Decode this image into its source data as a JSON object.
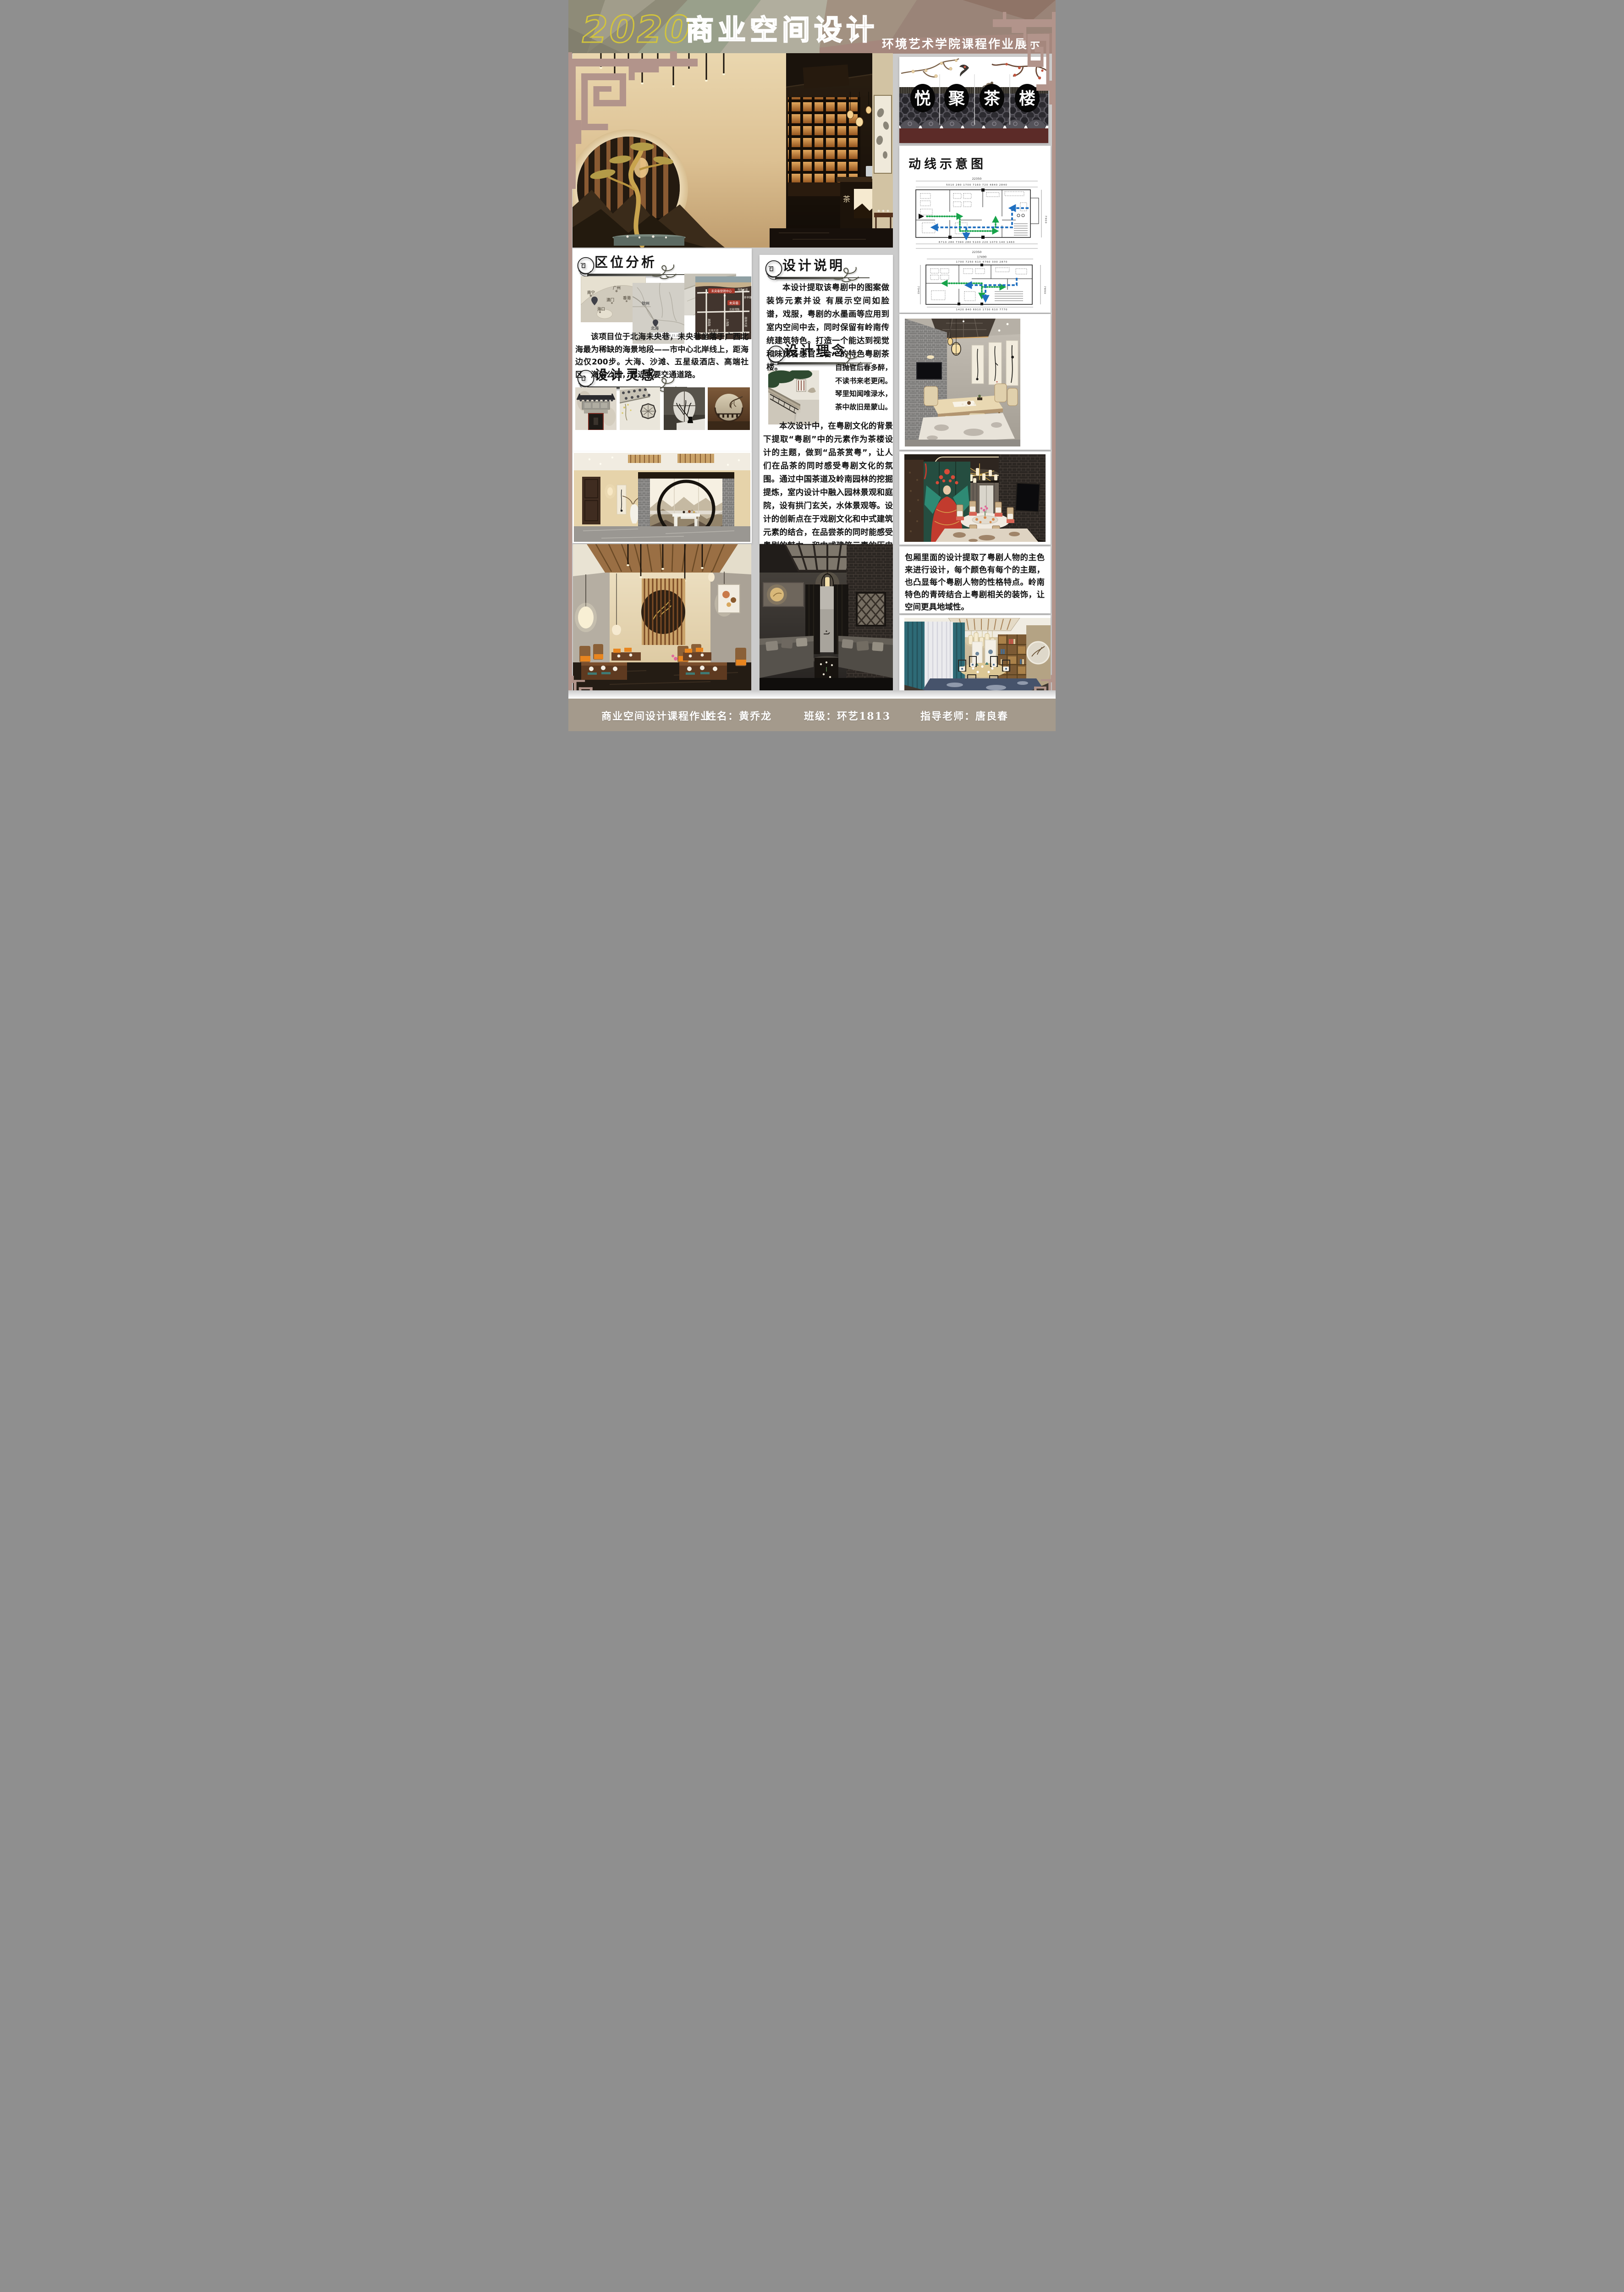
{
  "header": {
    "year": "2020",
    "title": "商业空间设计",
    "subtitle": "环境艺术学院课程作业展示"
  },
  "logo": {
    "char1": "悦",
    "char2": "聚",
    "char3": "茶",
    "char4": "楼"
  },
  "hero": {
    "desk_char": "茶"
  },
  "circulation": {
    "title": "动线示意图",
    "plan1_total_top": "22350",
    "plan1_dims_top": "5010   280  1700     7160      720    4840     2840",
    "plan1_dims_bottom": "6710    280     7390     280    5100   220 1070 140 1460",
    "plan1_total_bottom": "22350",
    "plan1_total_right": "7900",
    "plan2_total_top": "17490",
    "plan2_dims_top": "1700     7250     610    4760    300   2870",
    "plan2_dims_bottom": "1420 840   6910    1730 610    7770",
    "plan2_total_left": "7940",
    "plan2_total_right": "7890"
  },
  "location": {
    "title": "区位分析",
    "body": "该项目位于北海未央巷，未央巷坐落于广西北海最为稀缺的海景地段——市中心北岸线上，距海边仅200步。大海、沙滩、五星级酒店、高端社区、海滨公园，靠近主要交通道路。",
    "map1_label1": "南宁",
    "map1_label2": "广州",
    "map1_label3": "澳门",
    "map1_label4": "香港",
    "map1_label5": "海口",
    "map2_label1": "钦州",
    "map2_label2": "北海",
    "map2_label3": "北部湾",
    "map2_coords": "109.141678,21.214861",
    "map4_label1": "未央巷营销中心",
    "map4_label2": "未央巷",
    "map4_road1": "海景大道",
    "map4_road2": "北部湾路",
    "map4_road3": "北海大道",
    "map4_road4": "茶亭路",
    "map4_road5": "上海路",
    "map4_road6": "湖南路",
    "map4_road7": "南珠大道"
  },
  "inspiration": {
    "title": "设计灵感"
  },
  "description": {
    "title": "设计说明",
    "body": "本设计提取该粤剧中的图案做装饰元素并设 有展示空间如脸谱，戏服，粤剧的水墨画等应用到室内空间中去，同时保留有岭南传统建筑特色。打造一个能达到视觉和味觉各感官三合一的特色粤剧茶楼。"
  },
  "concept": {
    "title": "设计理念",
    "poem1": "自抛官后春多醉，",
    "poem2": "不读书来老更闲。",
    "poem3": "琴里知闻唯渌水，",
    "poem4": "茶中故旧是蒙山。"
  },
  "theme": {
    "body": "本次设计中，在粤剧文化的背景下提取“粤剧”中的元素作为茶楼设计的主题，做到“品茶赏粤”，让人们在品茶的同时感受粤剧文化的氛围。通过中国茶道及岭南园林的挖掘提炼，室内设计中融入园林景观和庭院，设有拱门玄关，水体景观等。设计的创新点在于戏剧文化和中式建筑元素的结合，在品尝茶的同时能感受粤剧的魅力，和中式建筑元素的历史感和文化归"
  },
  "private_room": {
    "body": "包厢里面的设计提取了粤剧人物的主色来进行设计，每个颜色有每个的主题，也凸显每个粤剧人物的性格特点。岭南特色的青砖结合上粤剧相关的装饰，让空间更具地域性。"
  },
  "footer": {
    "course": "商业空间设计课程作业",
    "name": "姓名：黄乔龙",
    "class": "班级：环艺1813",
    "teacher": "指导老师：唐良春"
  }
}
